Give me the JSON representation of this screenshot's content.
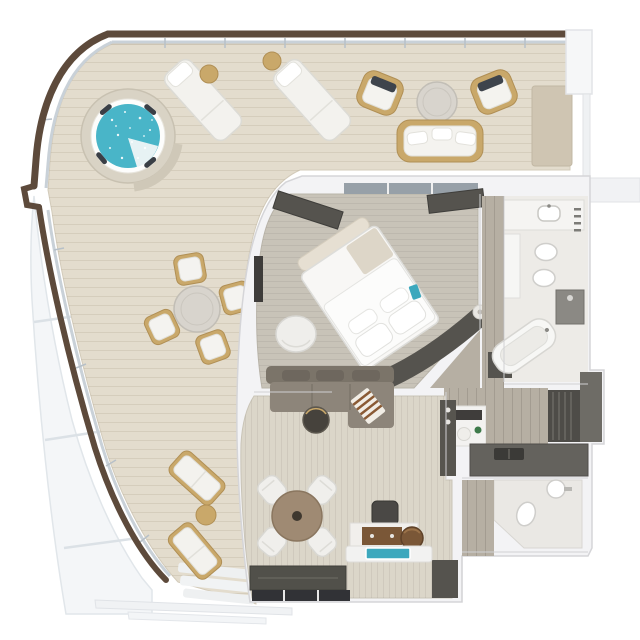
{
  "meta": {
    "title": "luxury-suite-3d-floor-plan",
    "view": "top-down 3d render",
    "canvas_px": "640x640"
  },
  "colors": {
    "background": "#ffffff",
    "deck_wood": "#e3dccd",
    "railing_brown": "#5d4a3b",
    "glass_balustrade": "#c9d1d8",
    "hull_white": "#f4f6f8",
    "spa_water": "#49b5c8",
    "spa_surround": "#d9d3c5",
    "outdoor_wood": "#c9a86a",
    "cushion_white": "#f3f2ee",
    "marble_table": "#d8d4cd",
    "outdoor_mat": "#cfc5b2",
    "wall_white": "#f3f3f5",
    "bedroom_carpet": "#c8c3b8",
    "living_carpet": "#dbd6c9",
    "wood_floor_gray": "#b6afa3",
    "bath_floor": "#edebe7",
    "dark_joinery": "#55534e",
    "sofa_taupe": "#8d857a",
    "sofa_back": "#7b7469",
    "throw_brown": "#8a5a34",
    "table_wood_brown": "#9f8a73",
    "leather_pouf": "#7a5737",
    "tv_screen_teal": "#3ca8bd",
    "window_glazing": "#97a0a8",
    "kitchen_counter": "#64625d"
  },
  "rooms": [
    {
      "id": "terrace",
      "name": "Wraparound Terrace"
    },
    {
      "id": "bedroom",
      "name": "Bedroom"
    },
    {
      "id": "master-bathroom",
      "name": "Master Bathroom"
    },
    {
      "id": "dressing-corridor",
      "name": "Dressing Corridor"
    },
    {
      "id": "living-room",
      "name": "Living / Dining Room"
    },
    {
      "id": "kitchenette",
      "name": "Kitchenette / Pantry"
    },
    {
      "id": "powder-room",
      "name": "Powder Room"
    }
  ],
  "furniture": {
    "terrace": [
      "whirlpool spa",
      "sun lounger x2",
      "round side table x2",
      "outdoor armchair x2",
      "outdoor sofa",
      "round stone coffee table",
      "outdoor dining table",
      "outdoor dining chair x4",
      "deck chair x2",
      "deck side table",
      "outdoor mat"
    ],
    "bedroom": [
      "king bed angled",
      "foot bench",
      "curved headboard console",
      "nightstand x2",
      "armchair",
      "wardrobe x2",
      "window band",
      "wall tv panel"
    ],
    "master_bathroom": [
      "vanity counter with sink",
      "tall cabinet",
      "toilet",
      "bidet",
      "shower",
      "bathtub"
    ],
    "dressing_corridor": [
      "vanity desk with mirror",
      "stool",
      "plant",
      "slatted wardrobe",
      "closet block"
    ],
    "living_room": [
      "l-shaped sectional sofa",
      "striped throw",
      "back pillows",
      "round coffee table",
      "round dining table",
      "dining chair x4",
      "writing desk",
      "desk chair",
      "leather pouf",
      "tv on media ledge",
      "sideboard",
      "bar cabinet",
      "shoe cabinet"
    ],
    "kitchenette": [
      "counter with sink",
      "slatted tall cabinet",
      "tall cabinet"
    ],
    "powder_room": [
      "toilet",
      "pedestal sink"
    ]
  }
}
